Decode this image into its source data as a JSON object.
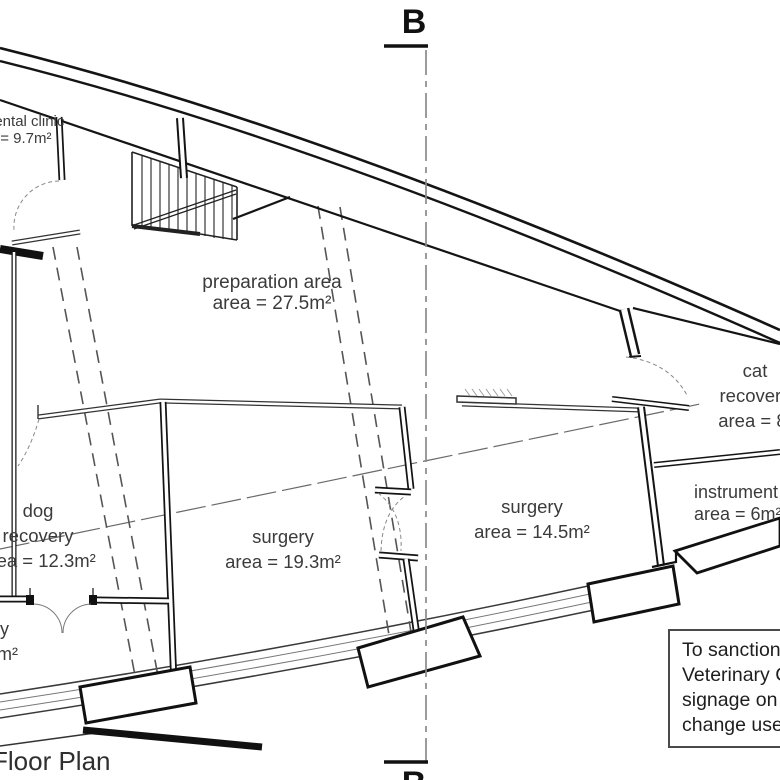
{
  "drawing": {
    "title": "Floor Plan",
    "section_marker": "B",
    "rooms": {
      "dental": {
        "name": "dental clinic",
        "area": "area = 9.7m²"
      },
      "prep": {
        "name": "preparation area",
        "area": "area = 27.5m²"
      },
      "cat": {
        "line1": "cat",
        "line2": "recovery",
        "area": "area = 8."
      },
      "instr": {
        "name": "instrument",
        "area": "area = 6m²"
      },
      "dog": {
        "line1": "dog",
        "line2": "recovery",
        "area": "area = 12.3m²"
      },
      "surgery1": {
        "name": "surgery",
        "area": "area = 19.3m²"
      },
      "surgery2": {
        "name": "surgery",
        "area": "area = 14.5m²"
      },
      "entry": {
        "line1": "y",
        "line2": "m²"
      }
    },
    "note_box": {
      "lines": [
        "To sanction",
        "Veterinary C",
        "signage on fa",
        "change use t"
      ]
    },
    "colors": {
      "wall": "#141414",
      "light_line": "#555555",
      "section_line": "#8a8a8a",
      "label_text": "#3b3b3b"
    }
  }
}
